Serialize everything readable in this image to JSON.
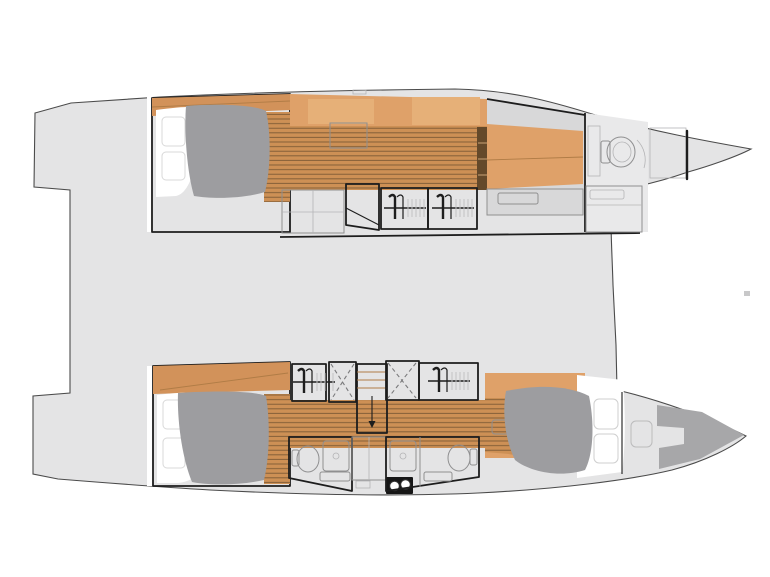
{
  "drawing": {
    "kind": "catamaran-deck-floor-plan",
    "orientation": "bows-right",
    "visible_text": []
  },
  "colors": {
    "background": "#ffffff",
    "deck": "#e4e4e5",
    "deck_edge": "#4b4b4b",
    "outline": "#1d1d1d",
    "wood": "#dfa169",
    "wood_dark": "#d2925a",
    "wood_light": "#e6b078",
    "plank_base": "#cd9055",
    "plank_line": "#7d5a35",
    "steps_dark": "#64492a",
    "steps_line": "#caa377",
    "mattress": "#9d9da0",
    "sheet": "#ffffff",
    "pillow_edge": "#d8d8d8",
    "cabinet": "#dcdcdd",
    "locker": "#efeff0",
    "bath_floor": "#e9e9ea",
    "bath_fixture": "#f7f7f7",
    "gray_mid": "#d8d8d9",
    "gray_shelf": "#d6d6d7",
    "bow_shadow": "#a7a7a9",
    "black_unit": "#161616",
    "tiny_fitting": "#c8c8c9",
    "hatch_edge": "#bbbbbc"
  },
  "icons": {
    "toilet": "toilet-icon",
    "shower": "shower-tray-icon",
    "sink_counter": "sink-counter-icon",
    "hangers": "clothes-hanger-icon",
    "wardrobe_cross": "wardrobe-x-door-icon",
    "stairs": "stairs-icon",
    "stairs_arrow": "down-arrow-icon",
    "bed": "double-bed-icon",
    "hatch": "floor-hatch-icon"
  },
  "structure": {
    "hulls": [
      {
        "id": "port-hull",
        "side": "top",
        "areas": 5
      },
      {
        "id": "starboard-hull",
        "side": "bottom",
        "areas": 6
      }
    ],
    "beds": 3,
    "heads": 3,
    "hanging_lockers": 4,
    "stairways": 2
  }
}
